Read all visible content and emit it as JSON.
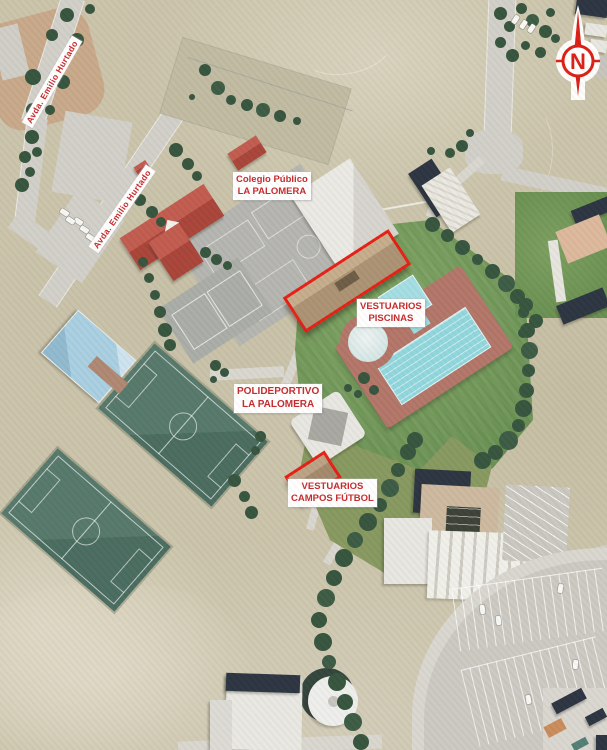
{
  "map": {
    "description": "Aerial orthophoto of the La Palomera sports and school complex with red planning annotations",
    "annotated_sites": [
      "Colegio Público LA PALOMERA",
      "VESTUARIOS PISCINAS",
      "POLIDEPORTIVO LA PALOMERA",
      "VESTUARIOS CAMPOS FÚTBOL"
    ]
  },
  "labels": {
    "street_top": "Avda. Emilio Hurtado",
    "street_mid": "Avda. Emilio Hurtado",
    "school": {
      "line1": "Colegio Público",
      "line2": "LA PALOMERA"
    },
    "pool_changing_rooms": {
      "line1": "VESTUARIOS",
      "line2": "PISCINAS"
    },
    "sports_center": {
      "line1": "POLIDEPORTIVO",
      "line2": "LA PALOMERA"
    },
    "football_changing_rooms": {
      "line1": "VESTUARIOS",
      "line2": "CAMPOS FÚTBOL"
    }
  },
  "compass": {
    "north": "N"
  },
  "colors": {
    "annotation": "#e51d12",
    "label_text": "#c5282c",
    "road": "#d1cfc8",
    "court": "#b4b4b0",
    "bldg": "#e7e6e1",
    "roof_red": "#a84238",
    "roof_navy": "#29323f",
    "tree": "#34523c",
    "lawn": "#6c9355",
    "pitch": "#4d7264",
    "water": "#8fd6dc",
    "deck": "#b27467",
    "dry": "#cac3aa"
  }
}
